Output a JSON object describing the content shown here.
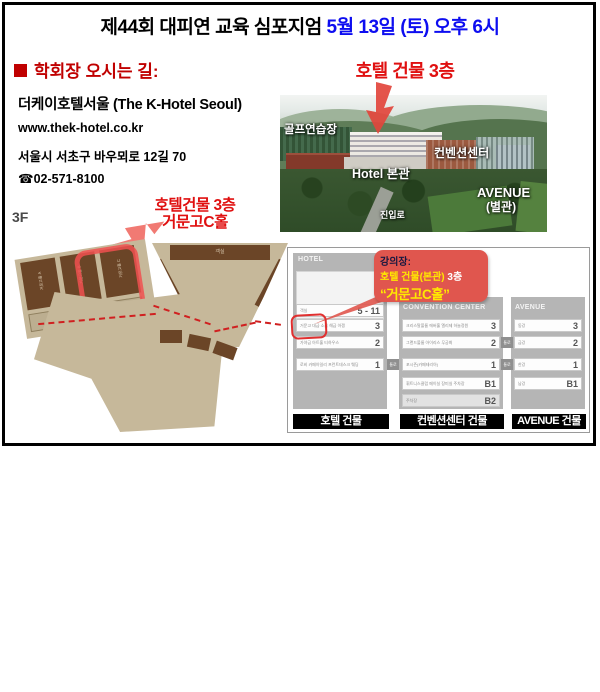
{
  "title": {
    "black": "제44회 대피연 교육 심포지엄",
    "blue": " 5월 13일 (토) 오후 6시"
  },
  "directions": {
    "heading": "학회장 오시는 길:",
    "hotel_name": "더케이호텔서울 (The K-Hotel Seoul)",
    "website": "www.thek-hotel.co.kr",
    "address": "서울시 서초구 바우뫼로 12길 70",
    "phone": "☎02-571-8100"
  },
  "photo": {
    "annotation": "호텔 건물 3층",
    "labels": {
      "golf": "골프연습장",
      "convention": "컨벤션센터",
      "hotel_main": "Hotel 본관",
      "avenue1": "AVENUE",
      "avenue2": "(별관)",
      "road": "진입로"
    }
  },
  "floorplan": {
    "floor_label": "3F",
    "annotation_line1": "호텔건물 3층",
    "annotation_line2": "거문고C홀",
    "room_a": "거문고홀 A",
    "room_b": "거문고홀 B",
    "room_c": "거문고홀 C",
    "guest_room": "객실"
  },
  "diagram": {
    "corridor": "통로",
    "bubble": {
      "line1": "강의장:",
      "line2_highlight": "호텔 건물(본관)",
      "line2_suffix": " 3층",
      "line3": "“거문고C홀”"
    },
    "hotel": {
      "header": "HOTEL",
      "footer": "호텔 건물",
      "rows": [
        {
          "label": "객실",
          "floor": "5 - 11"
        },
        {
          "label": "거문고 대금 소금 해금 아쟁",
          "floor": "3"
        },
        {
          "label": "가야금 아트홀 티하우스",
          "floor": "2"
        },
        {
          "label": "로비 카페아일리 프런트데스크 웨딩",
          "floor": "1"
        }
      ]
    },
    "convention": {
      "header": "CONVENTION CENTER",
      "footer": "컨벤션센터 건물",
      "rows": [
        {
          "label": "크리스탈볼룸 에버홀 엘리제 하늘정원",
          "floor": "3"
        },
        {
          "label": "그랜드볼룸 아이리스 무궁화",
          "floor": "2"
        },
        {
          "label": "포시즌(카페테리아)",
          "floor": "1"
        },
        {
          "label": "휘트니스클럽 메이실 장미실 주차장",
          "floor": "B1"
        },
        {
          "label": "주차장",
          "floor": "B2"
        }
      ]
    },
    "avenue": {
      "header": "AVENUE",
      "footer": "AVENUE 건물",
      "rows": [
        {
          "label": "동강",
          "floor": "3"
        },
        {
          "label": "금강",
          "floor": "2"
        },
        {
          "label": "한강",
          "floor": "1"
        },
        {
          "label": "남강",
          "floor": "B1"
        }
      ]
    }
  },
  "colors": {
    "title_blue": "#0d0df0",
    "heading_red": "#c00000",
    "annotation_red": "#e01010",
    "bubble_red": "#e0564e",
    "bubble_yellow": "#ffe800",
    "plan_tan": "#c6b89a",
    "plan_brown": "#6b4527",
    "diagram_gray": "#b5b5b5"
  }
}
